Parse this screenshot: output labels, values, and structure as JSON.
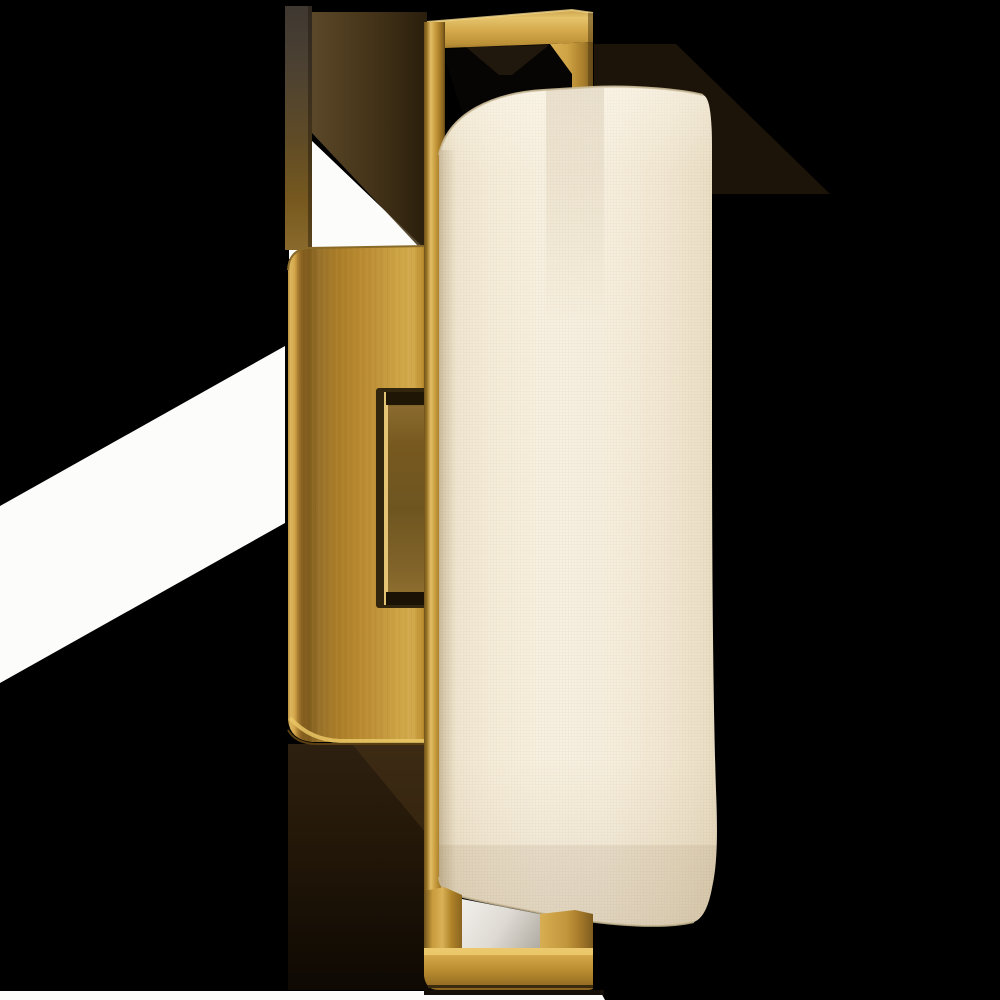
{
  "scene": {
    "description": "Product photograph of a hand-rubbed antique brass wall sconce with a rectangular backplate, L-shaped top and bottom bracket arms, a raised connector bar, and a tall cylindrical cream linen shade, shown on a black background with white masked patches and warm cast-shadow regions",
    "alt": "Brass bracket wall sconce with cylindrical linen shade"
  },
  "colors": {
    "background": "#000000",
    "mask_white": "#fcfcfb",
    "wall_shadow_streak": "#1d1409",
    "opening_dark": "#070503",
    "opening_hourglass": "#20170d",
    "wall_shadow_brown": "#5c4524",
    "below_plate_shadow": "#1c1207",
    "brass_highlight": "#ecca79",
    "brass_bright": "#d4a847",
    "brass_mid": "#b8892e",
    "brass_deep": "#8a6522",
    "brass_dark_edge": "#4a3512",
    "shade_cream": "#f4ebd8",
    "shade_cream_bright": "#f8f0e0",
    "shade_cream_edge": "#d9cbae",
    "shade_rim_line": "#cbbb99",
    "shade_bottom_line": "#c6b692",
    "bottom_opening_white": "#efede8",
    "bottom_opening_shadow": "#aaa69d",
    "under_bar_shadow": "#15100a"
  },
  "parts": {
    "background": {
      "label": "black backdrop"
    },
    "mask_band_left": {
      "label": "white masked band, left edge"
    },
    "mask_wedge": {
      "label": "white masked wedge above backplate"
    },
    "mask_strip_bottom": {
      "label": "white masked strip, bottom edge"
    },
    "shadow_strip": {
      "label": "dark vertical wall shadow strip"
    },
    "bracket_shadow": {
      "label": "brown cast shadow of top bracket"
    },
    "backplate": {
      "label": "rectangular brass backplate"
    },
    "connector": {
      "label": "raised brass connector bar on backplate"
    },
    "stem": {
      "label": "vertical brass stem arm"
    },
    "top_bracket": {
      "label": "L-shaped brass top bracket arm"
    },
    "bottom_bracket": {
      "label": "U-shaped brass bottom bracket arm"
    },
    "shade": {
      "label": "cylindrical cream linen shade"
    }
  }
}
